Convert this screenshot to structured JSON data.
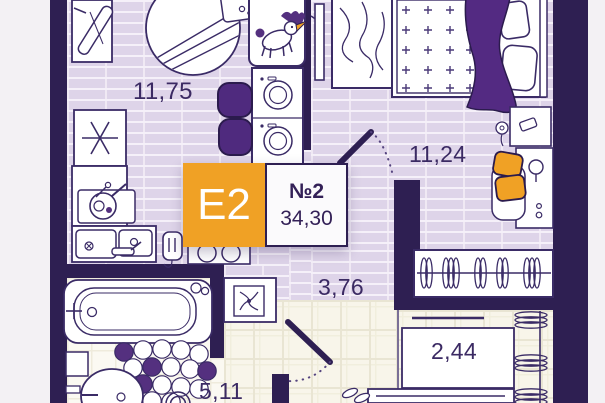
{
  "plan": {
    "badge": {
      "type": "Е2",
      "number": "№2",
      "area": "34,30"
    },
    "rooms": [
      {
        "id": "living-kitchen",
        "area_label": "11,75"
      },
      {
        "id": "bedroom",
        "area_label": "11,24"
      },
      {
        "id": "hallway",
        "area_label": "3,76"
      },
      {
        "id": "closet",
        "area_label": "2,44"
      },
      {
        "id": "bathroom",
        "area_label": "5,11"
      }
    ],
    "icons": [
      "unicorn-icon",
      "washing-machine-icon",
      "stove-burners-icon",
      "kitchen-sink-icon",
      "frying-pan-icon",
      "light-switch-icon",
      "table-lamp-icon",
      "power-socket-icon",
      "ventilation-fan-icon",
      "bathtub-icon",
      "washbasin-icon",
      "toilet-icon",
      "clothes-hanger-icon",
      "door-swing-icon",
      "tv-icon",
      "bed-icon",
      "pillow-icon",
      "curtain-icon",
      "round-rug-icon",
      "ironing-board-icon",
      "stool-icon",
      "shoes-icon",
      "flower-icon"
    ],
    "colors": {
      "wall": "#2e1f52",
      "accent_orange": "#f0a125",
      "accent_purple": "#54307f",
      "floor_brick": "#ded4e9",
      "floor_tile": "#f8f5ea",
      "label_text": "#3b2a63",
      "badge_text": "#ffffff"
    }
  }
}
